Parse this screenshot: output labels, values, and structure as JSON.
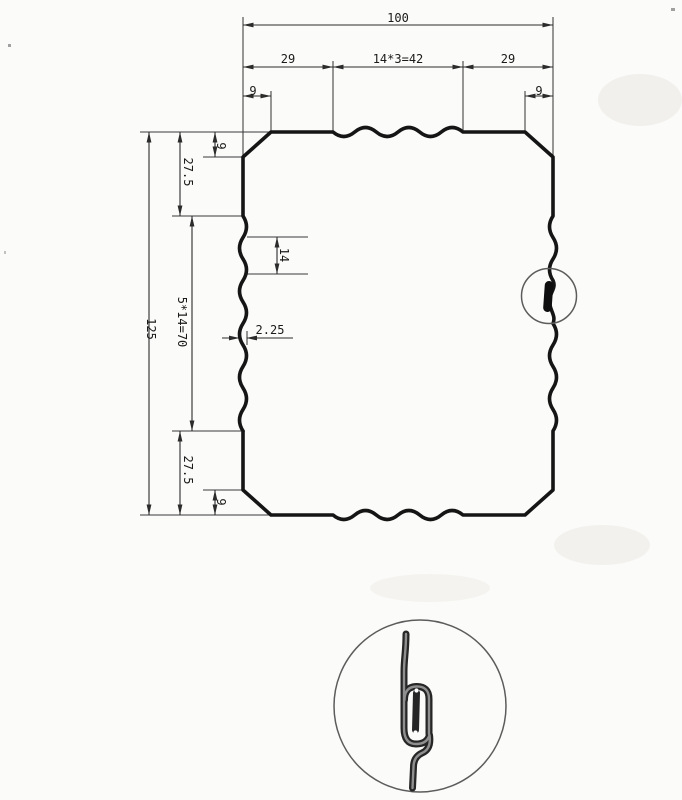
{
  "drawing": {
    "type": "sheet-metal profile cross-section, dimensioned engineering drawing",
    "dims": {
      "top_overall": "100",
      "top_seg_left": "29",
      "top_seg_mid": "14*3=42",
      "top_seg_right": "29",
      "top_chamfer_left": "9",
      "top_chamfer_right": "9",
      "side_overall": "125",
      "side_upper": "27.5",
      "side_wave": "5*14=70",
      "side_lower": "27.5",
      "side_chamfer_top": "9",
      "side_chamfer_bottom": "9",
      "wave_pitch": "14",
      "wave_depth": "2.25"
    },
    "colors": {
      "profile_line": "#151515",
      "dimension_line": "#2b2b2b",
      "detail_gray": "#8f8f8f",
      "background": "#fbfbf9"
    }
  }
}
